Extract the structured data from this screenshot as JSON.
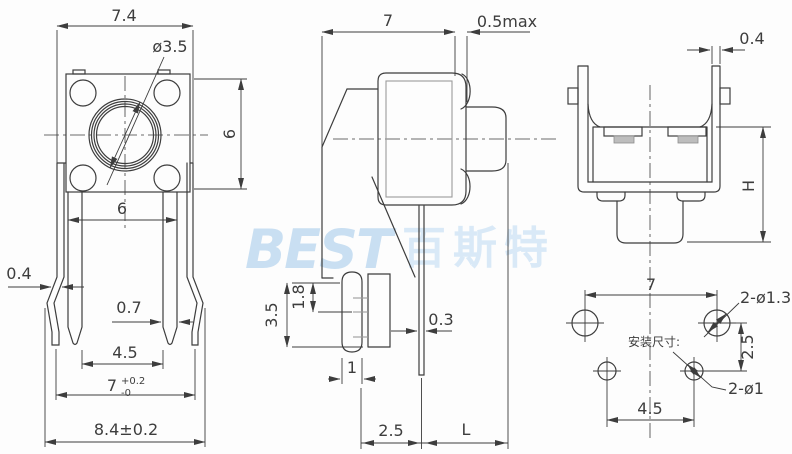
{
  "drawing": {
    "watermark": {
      "latin": "BEST",
      "cjk": "百斯特"
    },
    "colors": {
      "line": "#3d3d3d",
      "gray": "#9b9b9b",
      "watermark": "#c9dff2",
      "background": "#fdfdfd"
    },
    "front_view": {
      "overall_top": "7.4",
      "knob_diameter": "ø3.5",
      "body_height": "6",
      "pin_outer_span": "6",
      "bent_leg_width": "0.4",
      "pin_width": "0.7",
      "pin_inner_span": "4.5",
      "leg_span_value": "7",
      "leg_span_tol_up": "+0.2",
      "leg_span_tol_dn": "-0",
      "overall_bottom": "8.4±0.2"
    },
    "side_view": {
      "body_depth": "7",
      "gap_max": "0.5max",
      "base_height": "3.5",
      "slot_height": "1.8",
      "pin_thickness": "0.3",
      "peg_width": "1",
      "pin_setback": "2.5",
      "lead_length": "L"
    },
    "back_view": {
      "wall_thickness": "0.4",
      "height": "H"
    },
    "mounting_layout": {
      "label": "安装尺寸:",
      "top_hole_span": "7",
      "top_holes": "2-ø1.3",
      "row_spacing": "2.5",
      "bottom_holes": "2-ø1",
      "bottom_hole_span": "4.5"
    }
  }
}
